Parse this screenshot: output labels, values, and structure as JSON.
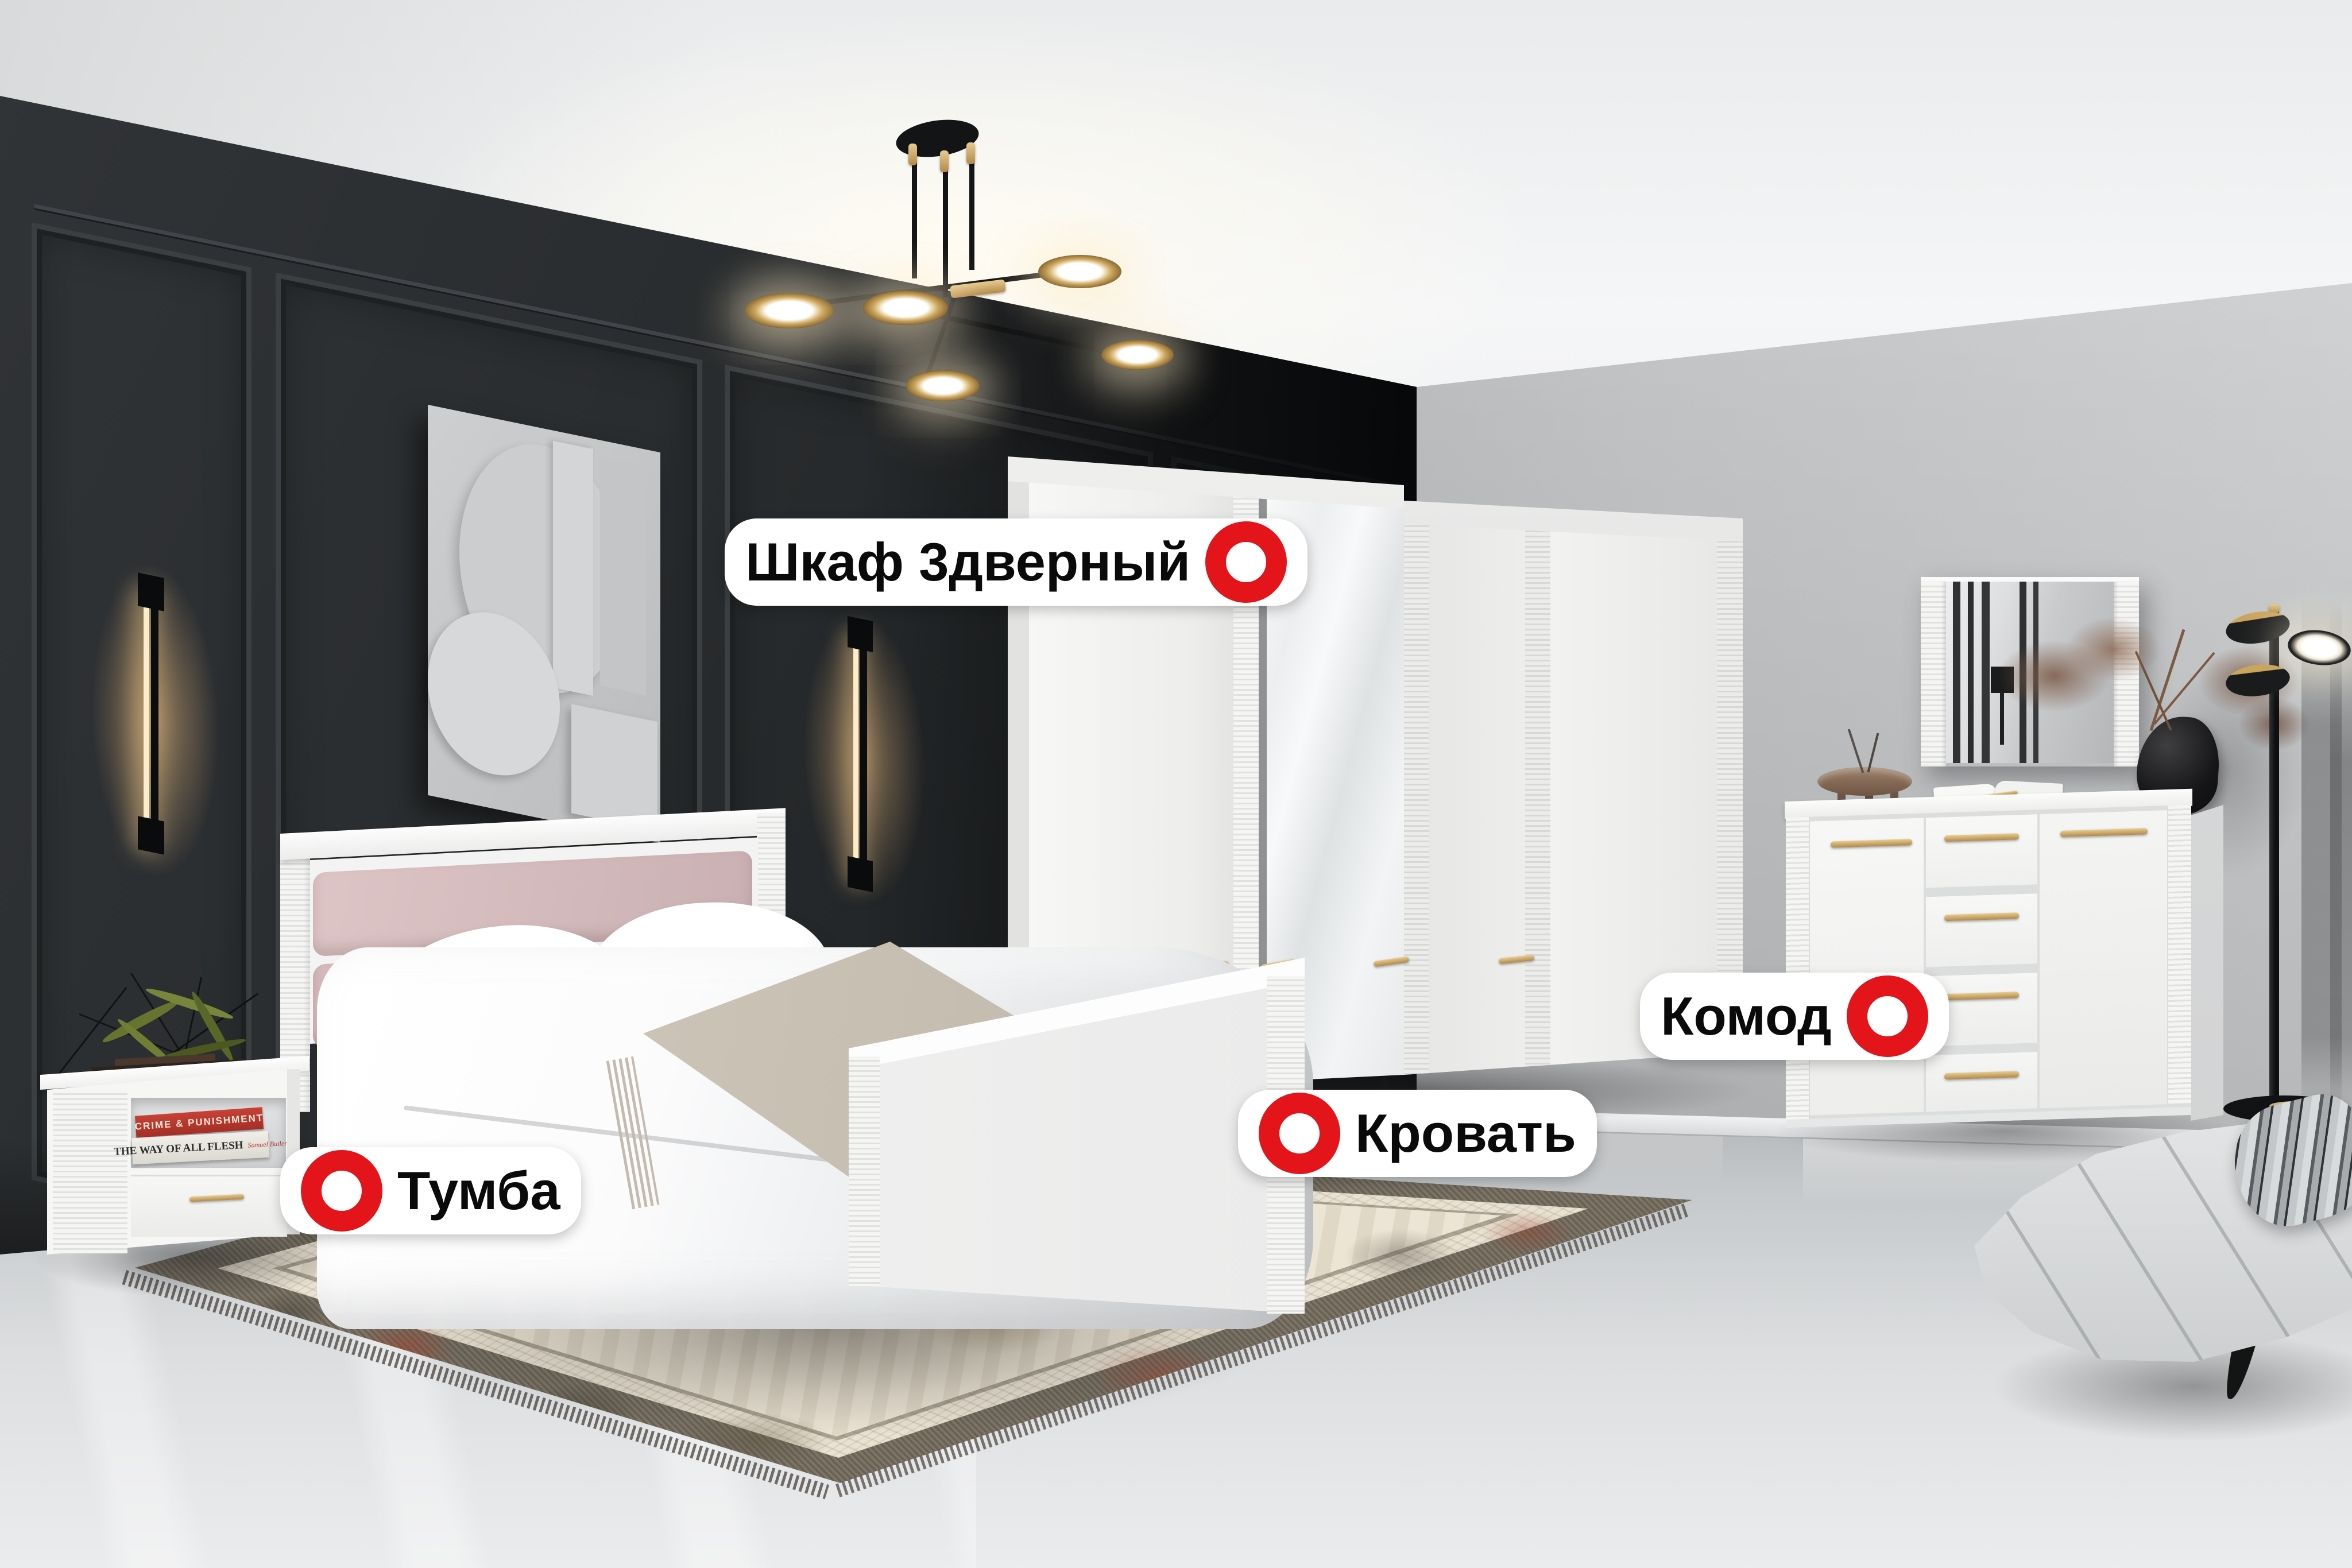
{
  "annotations": {
    "marker_color": "#e3141a",
    "pill_background": "#ffffff",
    "text_color": "#0a0a0a",
    "labels": [
      {
        "id": "wardrobe",
        "text": "Шкаф 3дверный",
        "marker_side": "right"
      },
      {
        "id": "bed",
        "text": "Кровать",
        "marker_side": "left"
      },
      {
        "id": "nightstand",
        "text": "Тумба",
        "marker_side": "left"
      },
      {
        "id": "dresser",
        "text": "Комод",
        "marker_side": "right"
      }
    ]
  },
  "scene": {
    "decor_books": [
      {
        "title": "CRIME & PUNISHMENT"
      },
      {
        "title": "THE WAY OF ALL FLESH",
        "author": "Samuel Butler"
      }
    ],
    "colors": {
      "marker_red": "#e3141a",
      "accent_gold": "#c9a25f",
      "dark_wall": "#2a2d2f",
      "light_wall": "#b9bbbd",
      "floor": "#d9dbdd",
      "headboard_pink": "#d3b9ba"
    }
  }
}
